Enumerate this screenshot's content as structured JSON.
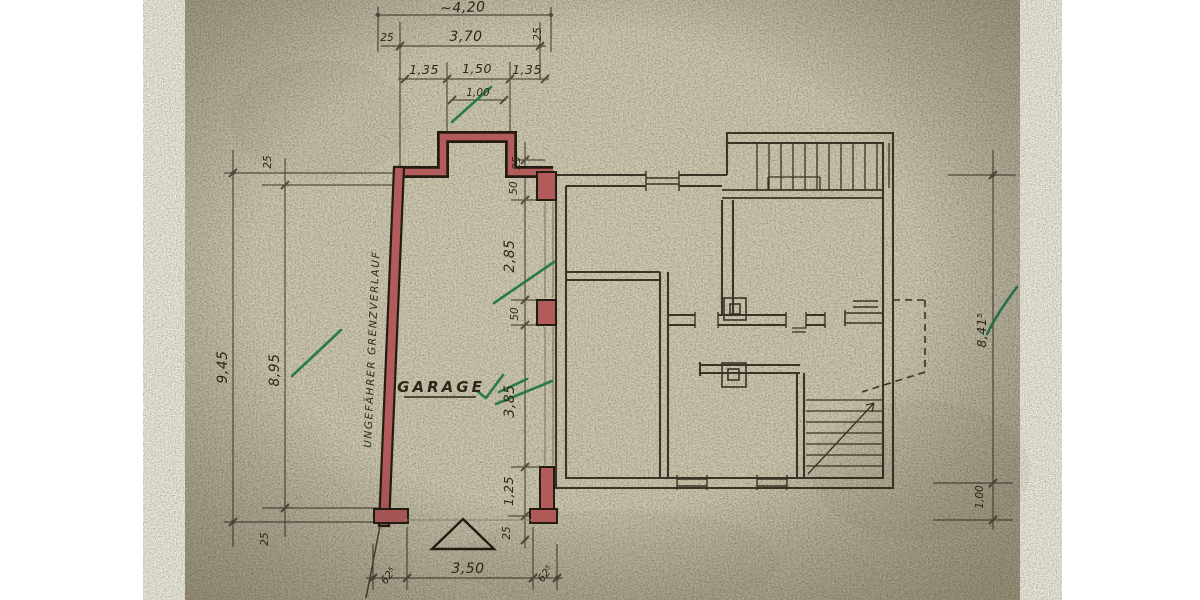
{
  "plan": {
    "labels": {
      "garage": "GARAGE",
      "boundary": "UNGEFÄHRER GRENZVERLAUF"
    },
    "dimensions": {
      "top": {
        "total": "~4,20",
        "wall_left": "25",
        "clear_width": "3,70",
        "wall_right": "25",
        "seg_left": "1,35",
        "seg_center": "1,50",
        "seg_right": "1,35",
        "opening": "1,00"
      },
      "left": {
        "total": "9,45",
        "clear_depth": "8,95",
        "wall_top": "25",
        "wall_bottom": "25"
      },
      "middle": {
        "wall_top": "25",
        "pier_upper": "50",
        "opening_upper": "2,85",
        "pier_mid": "50",
        "opening_lower": "3,85",
        "pier_lower": "1,25",
        "wall_bottom": "25"
      },
      "bottom": {
        "pier_left": "62⁵",
        "door_width": "3,50",
        "pier_right": "62⁵"
      },
      "right": {
        "wall_height": "8,41⁵",
        "offset": "1,00"
      }
    },
    "colors": {
      "paper": "#b9b297",
      "ink": "#3a3226",
      "new_wall_red": "#b25b5b",
      "check_green": "#23774a"
    }
  }
}
